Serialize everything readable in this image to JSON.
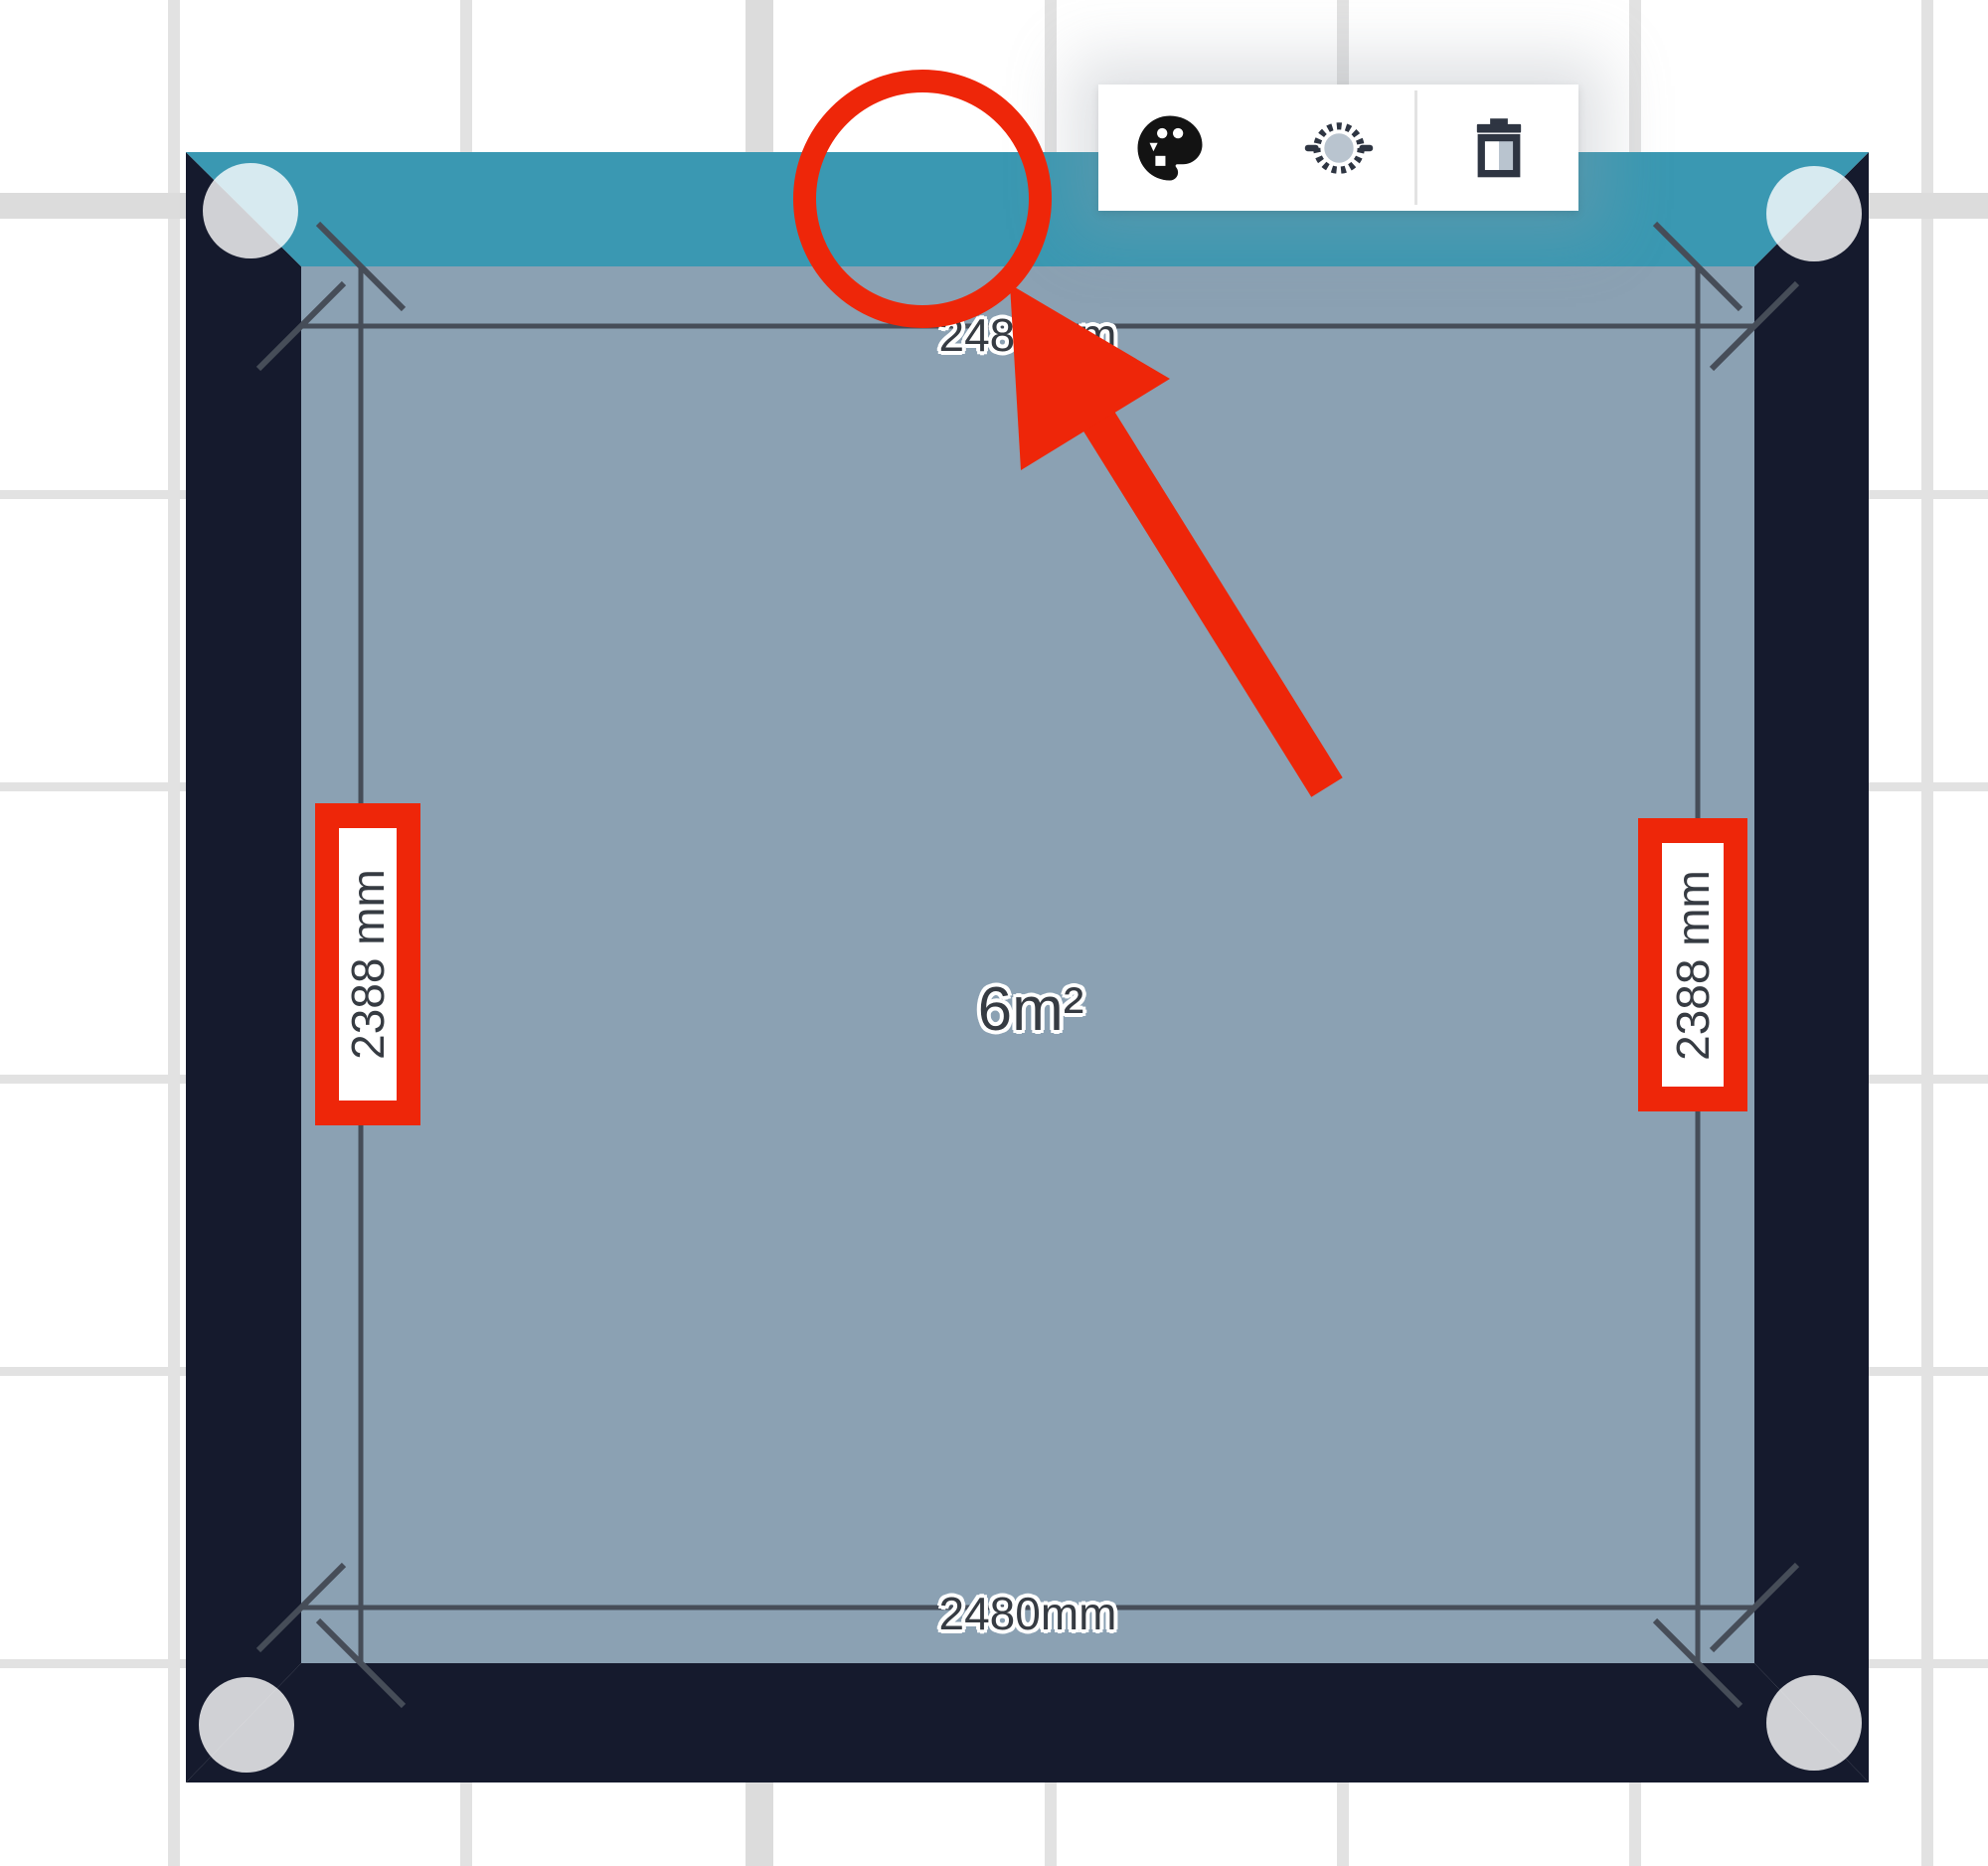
{
  "room": {
    "area_label": "6m²",
    "dimension_top": "2480mm",
    "dimension_bottom": "2480mm",
    "dimension_left": "2388 mm",
    "dimension_right": "2388 mm"
  },
  "toolbar": {
    "buttons": [
      {
        "id": "color",
        "icon": "palette-icon"
      },
      {
        "id": "rotate",
        "icon": "rotate-icon"
      },
      {
        "id": "delete",
        "icon": "trash-icon"
      }
    ]
  },
  "colors": {
    "wall_selected": "#3a98b2",
    "wall": "#151a2d",
    "floor": "#8ba1b3",
    "dim_line": "#464d58",
    "dim_text": "#363b42",
    "grid_line": "#e2e2e2",
    "grid_line_major": "#dcdcdc",
    "annotation_red": "#ee2609",
    "icon_dark": "#2e3542",
    "icon_light": "#b9c4cf"
  }
}
